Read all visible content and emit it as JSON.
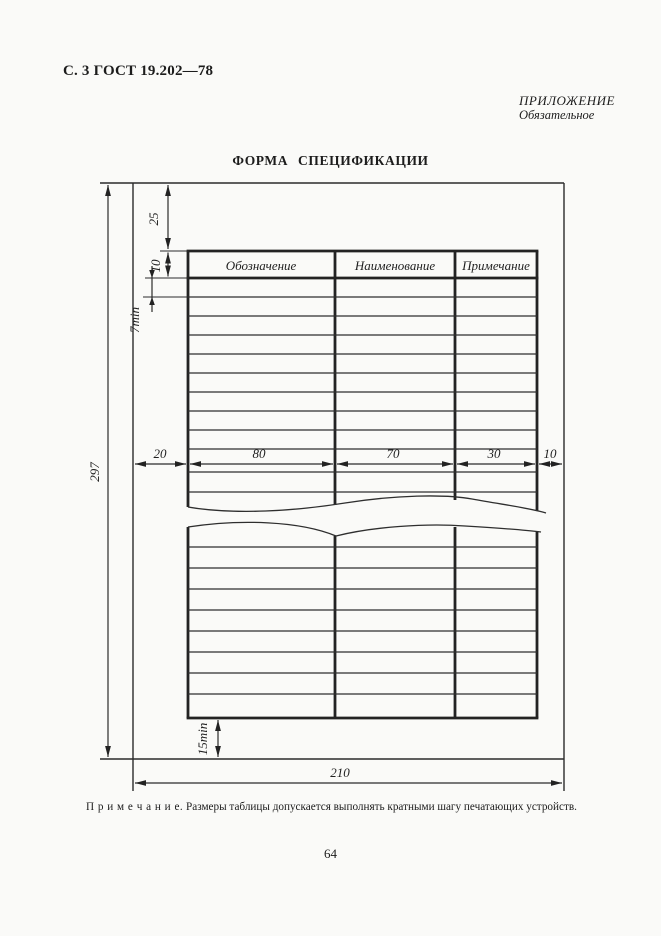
{
  "page": {
    "header_left": "С. 3 ГОСТ 19.202—78",
    "annex_title": "ПРИЛОЖЕНИЕ",
    "annex_subtitle": "Обязательное",
    "title": "ФОРМА СПЕЦИФИКАЦИИ",
    "note_label": "П р и м е ч а н и е.",
    "note_text": "Размеры таблицы допускается выполнять кратными шагу печатающих устройств.",
    "page_number": "64"
  },
  "drawing": {
    "columns": [
      "Обозначение",
      "Наименование",
      "Примечание"
    ],
    "dims": {
      "sheet_height": "297",
      "sheet_width": "210",
      "top_margin": "25",
      "header_height": "10",
      "row_height": "7min",
      "left_margin": "20",
      "col_designation_width": "80",
      "col_name_width": "70",
      "col_note_width": "30",
      "right_margin": "10",
      "bottom_margin": "15min"
    },
    "colors": {
      "ink": "#222222",
      "paper": "#fafaf8"
    }
  }
}
